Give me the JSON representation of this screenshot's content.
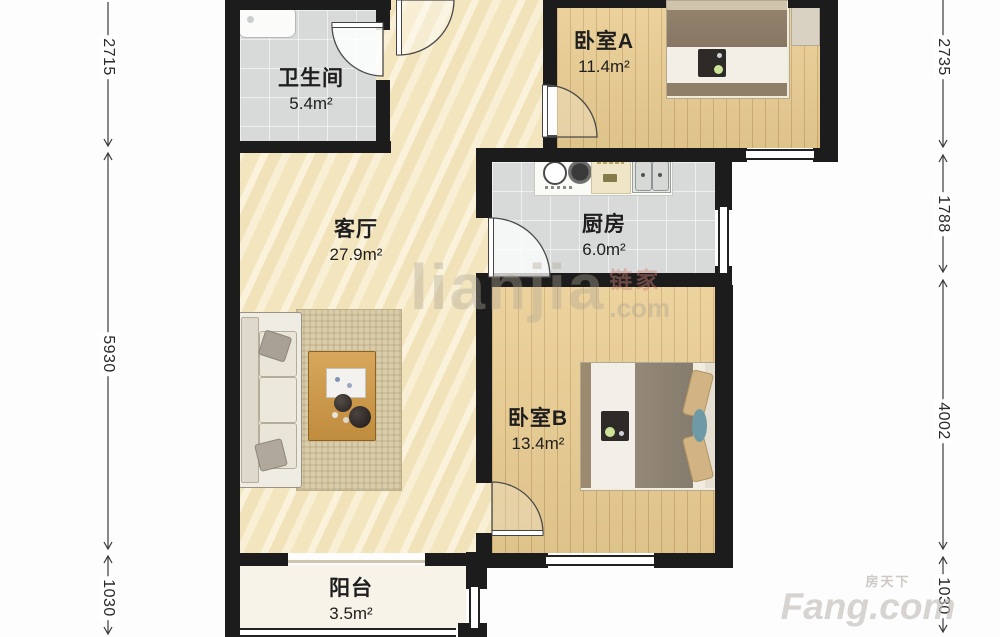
{
  "floorplan": {
    "rooms": [
      {
        "id": "bathroom",
        "name": "卫生间",
        "area": "5.4m²"
      },
      {
        "id": "living-room",
        "name": "客厅",
        "area": "27.9m²"
      },
      {
        "id": "kitchen",
        "name": "厨房",
        "area": "6.0m²"
      },
      {
        "id": "bedroom-a",
        "name": "卧室A",
        "area": "11.4m²"
      },
      {
        "id": "bedroom-b",
        "name": "卧室B",
        "area": "13.4m²"
      },
      {
        "id": "balcony",
        "name": "阳台",
        "area": "3.5m²"
      }
    ],
    "dim_left": [
      "2715",
      "5930",
      "1030"
    ],
    "dim_right": [
      "2735",
      "1788",
      "4002",
      "1030"
    ],
    "watermarks": {
      "brand": "lianjia",
      "brand_cn": "链家",
      "brand_suffix": ".com",
      "corner_cn": "房天下",
      "corner_brand": "Fang.com"
    },
    "colors": {
      "wall": "#1c1c1c",
      "wood_floor": "#eacd92",
      "tile_floor": "#d8dad9",
      "marble_floor": "#f3e6c0",
      "balcony_floor": "#f7f3e8"
    }
  }
}
